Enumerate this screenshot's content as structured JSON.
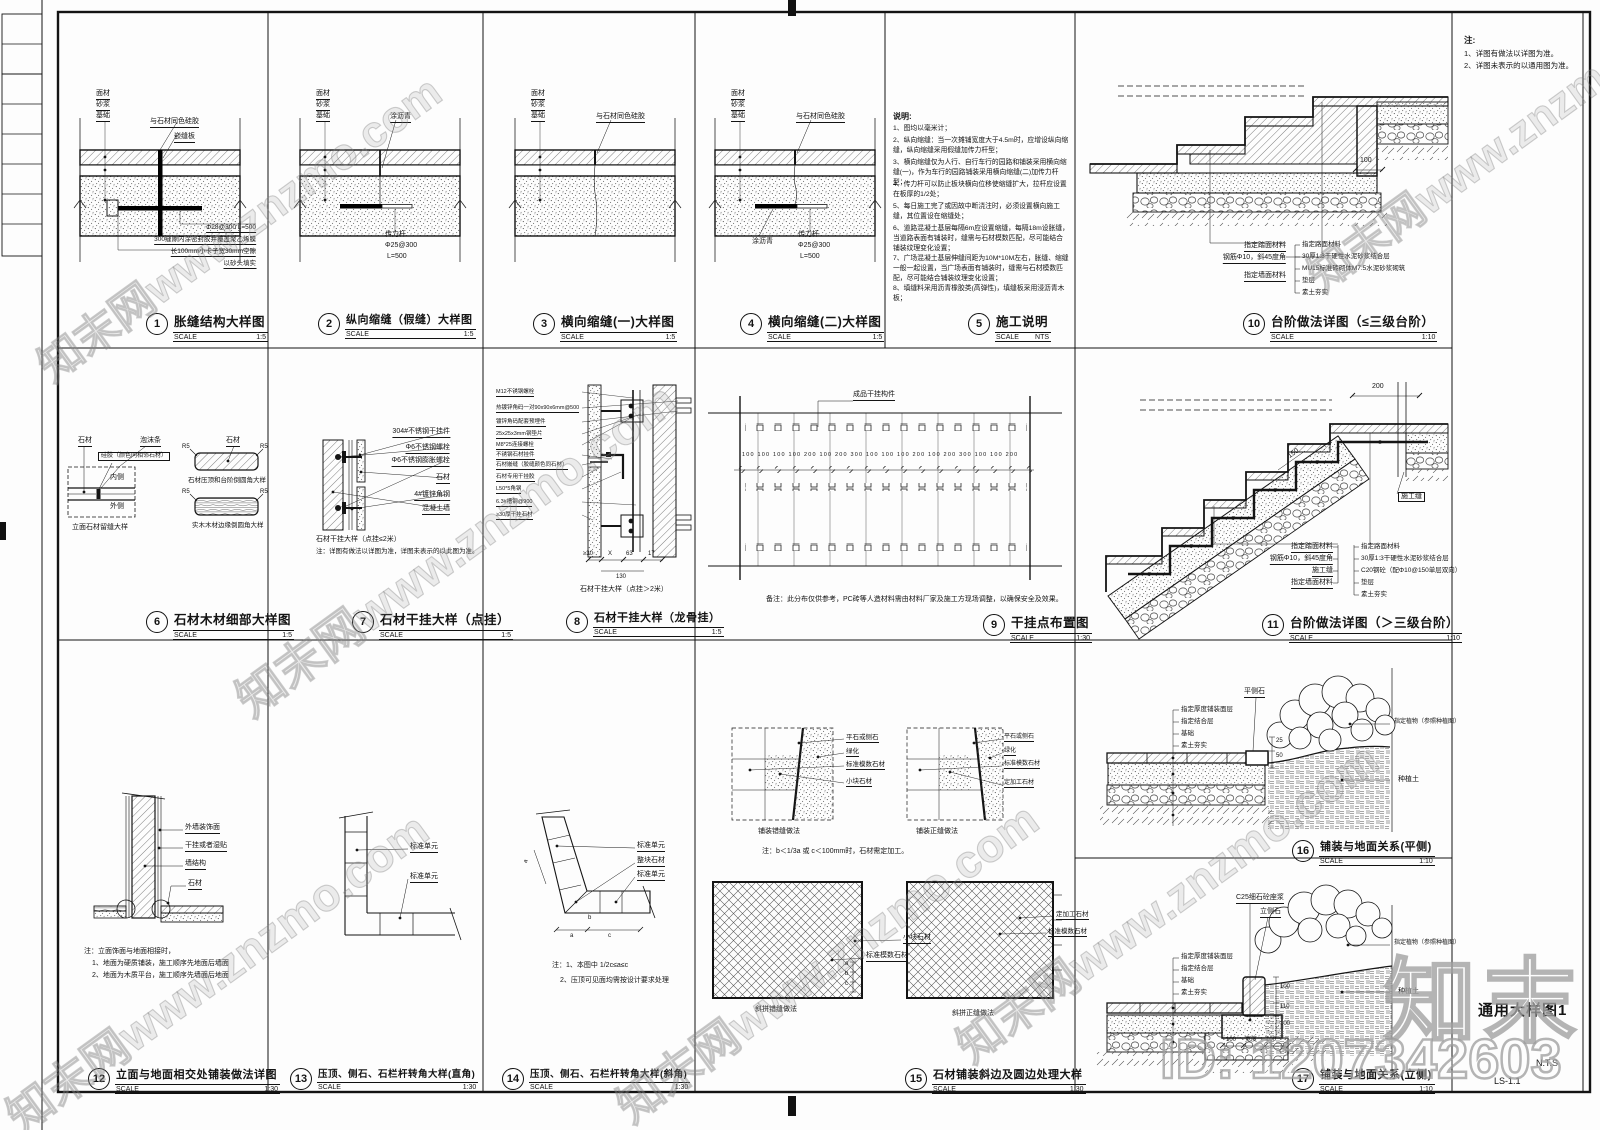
{
  "sheet": {
    "frame_note_heading": "注:",
    "frame_notes": [
      "1、详图有做法以详图为准。",
      "2、详图未表示的以通用图为准。"
    ],
    "drawing_name": "通用大样图1",
    "scale_text": "N.T.S",
    "sheet_no": "LS-1.1"
  },
  "watermark": {
    "tile": "知末网www.znzmo.com",
    "brand": "知末",
    "id_text": "ID: 1207342603"
  },
  "details": {
    "d1": {
      "num": "1",
      "title": "胀缝结构大样图",
      "scale_label": "SCALE",
      "scale": "1:5",
      "layers": [
        "面材",
        "砂浆",
        "基础"
      ],
      "callout1": "与石材同色硅胶",
      "callout2": "嵌缝板",
      "notes": [
        "Φ28@300 L=500",
        "300缝隙内涂密封胶并覆盖聚乙烯膜",
        "长100mm小卡子宽30mm空隙",
        "以砂头填实"
      ]
    },
    "d2": {
      "num": "2",
      "title": "纵向缩缝（假缝）大样图",
      "scale_label": "SCALE",
      "scale": "1:5",
      "layers": [
        "面材",
        "砂浆",
        "基础"
      ],
      "callout1": "涂沥青",
      "notes": [
        "传力杆",
        "Φ25@300",
        "L=500"
      ]
    },
    "d3": {
      "num": "3",
      "title": "横向缩缝(一)大样图",
      "scale_label": "SCALE",
      "scale": "1:5",
      "layers": [
        "面材",
        "砂浆",
        "基础"
      ],
      "callout1": "与石材同色硅胶"
    },
    "d4": {
      "num": "4",
      "title": "横向缩缝(二)大样图",
      "scale_label": "SCALE",
      "scale": "1:5",
      "layers": [
        "面材",
        "砂浆",
        "基础"
      ],
      "callout1": "与石材同色硅胶",
      "callout2": "涂沥青",
      "notes": [
        "传力杆",
        "Φ25@300",
        "L=500"
      ]
    },
    "d5": {
      "num": "5",
      "title": "施工说明",
      "scale_label": "SCALE",
      "scale": "NTS",
      "heading": "说明:",
      "items": [
        "1、图均以毫米计；",
        "2、纵向缩缝：当一次摊铺宽度大于4.5m时，应增设纵向缩缝，纵向缩缝采用假缝加传力杆型；",
        "3、横向缩缝仅为人行、自行车行的园路和铺装采用横向缩缝(一)，作为车行的园路铺装采用横向缩缝(二)加传力杆型；",
        "4、传力杆可以防止板块横向位移使缩缝扩大，拉杆应设置在板厚的1/2处；",
        "5、每日施工完了或因故中断浇注时，必须设置横向施工缝，其位置设在缩缝处；",
        "6、道路混凝土基层每隔6m应设置缩缝，每隔18m设胀缝，当道路表面有铺装时，缝需与石材模数匹配，尽可能结合铺装纹理变化设置；",
        "7、广场混凝土基层伸缝间距为10M*10M左右，胀缝、缩缝一般一起设置，当广场表面有铺装时，缝需与石材模数匹配，尽可能结合铺装纹理变化设置；",
        "8、填缝料采用沥青橡胶类(高弹性)，填缝板采用浸沥青木板；"
      ]
    },
    "d6": {
      "num": "6",
      "title": "石材木材细部大样图",
      "scale_label": "SCALE",
      "scale": "1:5",
      "labels": [
        "石材",
        "泡沫条",
        "硅胶（颜色同相邻石材）",
        "内侧",
        "外侧",
        "石材"
      ],
      "r_label": "R5",
      "captions": [
        "立面石材留缝大样",
        "石材压顶和台阶倒圆角大样",
        "实木木材边缘倒圆角大样"
      ]
    },
    "d7": {
      "num": "7",
      "title": "石材干挂大样（点挂）",
      "scale_label": "SCALE",
      "scale": "1:5",
      "labels": [
        "304#不锈钢干挂件",
        "Φ6不锈钢螺栓",
        "Φ6不锈钢膨胀螺栓",
        "石材",
        "4#镀锌角钢",
        "混凝土墙"
      ],
      "caption": "石材干挂大样（点挂≤2米）",
      "note": "注：详图有做法以详图为准，详图未表示的以此图为准。"
    },
    "d8": {
      "num": "8",
      "title": "石材干挂大样（龙骨挂）",
      "scale_label": "SCALE",
      "scale": "1:5",
      "labels": [
        "M12不锈钢螺栓",
        "热镀锌角码一对90x90x6mm@500",
        "镀锌角码配套预埋件",
        "25x25x3mm钢垫片",
        "M8*25连接螺栓",
        "不锈钢石材挂件",
        "石材嵌缝（胶缝颜色同石材）",
        "石材专用干挂胶",
        "L50*5角钢",
        "6.3#槽钢@900",
        "≥30厚干挂石材"
      ],
      "dims": [
        "≥30",
        "X",
        "63",
        "17",
        "130"
      ],
      "caption": "石材干挂大样（点挂＞2米）"
    },
    "d9": {
      "num": "9",
      "title": "干挂点布置图",
      "scale_label": "SCALE",
      "scale": "1:30",
      "label": "成品干挂构件",
      "dims": "100 100 100 100 200 100 200 300 100 100 100 200 100 200 300 100 100 200",
      "note": "备注：此分布仅供参考，PC砖等人造材料需由材料厂家及施工方现场调整，以确保安全及效果。"
    },
    "d10": {
      "num": "10",
      "title": "台阶做法详图（≤三级台阶）",
      "scale_label": "SCALE",
      "scale": "1:10",
      "left_labels": [
        "指定踏面材料",
        "钢筋Φ10，斜45度角",
        "指定墙面材料"
      ],
      "right_labels": [
        "指定路面材料",
        "30厚1:3干硬性水泥砂浆结合层",
        "MU15标准砖砌体M7.5水泥砂浆砌筑",
        "垫层",
        "素土夯实"
      ],
      "dim": "100"
    },
    "d11": {
      "num": "11",
      "title": "台阶做法详图（＞三级台阶）",
      "scale_label": "SCALE",
      "scale": "1:10",
      "left_labels": [
        "指定踏面材料",
        "钢筋Φ10，斜45度角",
        "施工缝",
        "指定墙面材料"
      ],
      "right_labels": [
        "指定路面材料",
        "30厚1:3干硬性水泥砂浆结合层",
        "C20钢砼（配Φ10@150单层双向）",
        "垫层",
        "素土夯实"
      ],
      "joint_label": "施工缝",
      "dims": [
        "200",
        "150"
      ]
    },
    "d12": {
      "num": "12",
      "title": "立面与地面相交处铺装做法详图",
      "scale_label": "SCALE",
      "scale": "1:30",
      "labels": [
        "外墙装饰面",
        "干挂或者湿贴",
        "墙结构",
        "石材"
      ],
      "notes": [
        "注：立面饰面与地面相接时，",
        "1、地面为硬质铺装，施工顺序先地面后墙面",
        "2、地面为木质平台，施工顺序先墙面后地面"
      ]
    },
    "d13": {
      "num": "13",
      "title": "压顶、侧石、石栏杆转角大样(直角)",
      "scale_label": "SCALE",
      "scale": "1:30",
      "labels": [
        "标准单元",
        "标准单元"
      ]
    },
    "d14": {
      "num": "14",
      "title": "压顶、侧石、石栏杆转角大样(斜角)",
      "scale_label": "SCALE",
      "scale": "1:30",
      "labels": [
        "标准单元",
        "整块石材",
        "标准单元"
      ],
      "dim_letters": [
        "a",
        "b",
        "a",
        "c"
      ],
      "notes": [
        "注：1、本图中 1/2c≤a≤c",
        "2、压顶可见面均需按设计要求处理"
      ]
    },
    "d15": {
      "num": "15",
      "title": "石材铺装斜边及圆边处理大样",
      "scale_label": "SCALE",
      "scale": "1:30",
      "caption_tl": "铺装错缝做法",
      "caption_tr": "铺装正缝做法",
      "caption_bl": "斜拼错缝做法",
      "caption_br": "斜拼正缝做法",
      "labels_tl": [
        "平石或侧石",
        "绿化",
        "标准模数石材",
        "小块石材"
      ],
      "labels_tr": [
        "平石或侧石",
        "绿化",
        "标准模数石材",
        "定加工石材"
      ],
      "labels_bl": [
        "小块石材",
        "标准模数石材"
      ],
      "labels_br": [
        "定加工石材",
        "标准模数石材"
      ],
      "dim_letters": [
        "a",
        "b",
        "c"
      ],
      "note": "注：b＜1/3a 或 c＜100mm时，石材需定加工。"
    },
    "d16": {
      "num": "16",
      "title": "铺装与地面关系(平侧)",
      "scale_label": "SCALE",
      "scale": "1:10",
      "left_labels": [
        "指定厚度铺装面层",
        "指定结合层",
        "基础",
        "素土夯实"
      ],
      "curb_label": "平侧石",
      "right_labels": [
        "指定植物（参照种植图）",
        "种植土"
      ],
      "dims": [
        "25",
        "50"
      ]
    },
    "d17": {
      "num": "17",
      "title": "铺装与地面关系(立侧)",
      "scale_label": "SCALE",
      "scale": "1:10",
      "top_labels": [
        "C25细石砼座浆",
        "立侧石"
      ],
      "left_labels": [
        "指定厚度铺装面层",
        "指定结合层",
        "基础",
        "素土夯实"
      ],
      "right_labels": [
        "指定植物（参照种植图）",
        "种植土"
      ],
      "dims": [
        "100",
        "110",
        "100"
      ],
      "bottom_dims": [
        "100",
        "宽度",
        "100"
      ]
    }
  }
}
